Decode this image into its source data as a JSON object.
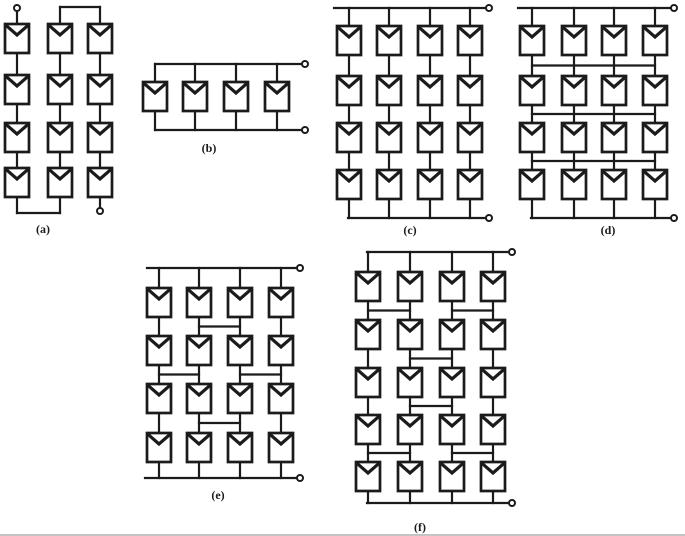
{
  "figure": {
    "canvas": {
      "width": 685,
      "height": 536
    },
    "background": "#ffffff",
    "line_color": "#1b1b1b",
    "edge_line_color": "#c4c4c4",
    "wire_width": 2.2,
    "terminal_radius": 3,
    "label_font_size": 12,
    "module": {
      "width": 24,
      "height": 29,
      "notch": 11,
      "stroke": 2.7,
      "notch_stroke": 3.2
    },
    "diagrams": [
      {
        "id": "a",
        "label": "(a)",
        "config": "series-serpentine-string",
        "kind": "serpentine",
        "col_x": [
          17,
          60,
          100
        ],
        "row_y": [
          24,
          75,
          123,
          168
        ],
        "top_bridge_y": 7,
        "bottom_bridge_y": 213,
        "top_terminal": {
          "x": 17,
          "y": 8
        },
        "bottom_terminal": {
          "x": 100,
          "y": 211
        },
        "label_pos": [
          43,
          229
        ]
      },
      {
        "id": "b",
        "label": "(b)",
        "config": "parallel",
        "kind": "parallel",
        "module_x": [
          155,
          195,
          236,
          277
        ],
        "row_y": 82,
        "top_bus_y": 64,
        "bottom_bus_y": 130,
        "right_x": 305,
        "label_pos": [
          209,
          148
        ]
      },
      {
        "id": "c",
        "label": "(c)",
        "config": "series-parallel",
        "kind": "ladder",
        "col_x": [
          349,
          389,
          430,
          470
        ],
        "row_y": [
          26,
          76,
          123,
          170
        ],
        "top_bus_y": 8,
        "bottom_bus_y": 218,
        "right_x": 489,
        "bus_left_top": 334,
        "bus_left_bottom": 348,
        "ties": [],
        "label_pos": [
          410,
          230
        ]
      },
      {
        "id": "d",
        "label": "(d)",
        "config": "total-cross-tied",
        "kind": "ladder",
        "col_x": [
          532,
          574,
          614,
          655
        ],
        "row_y": [
          26,
          76,
          123,
          170
        ],
        "top_bus_y": 8,
        "bottom_bus_y": 218,
        "right_x": 674,
        "bus_left_top": 518,
        "bus_left_bottom": 531,
        "ties": [
          {
            "gap": 0,
            "spans": [
              [
                0,
                3
              ]
            ]
          },
          {
            "gap": 1,
            "spans": [
              [
                0,
                3
              ]
            ]
          },
          {
            "gap": 2,
            "spans": [
              [
                0,
                3
              ]
            ]
          }
        ],
        "label_pos": [
          608,
          230
        ]
      },
      {
        "id": "e",
        "label": "(e)",
        "config": "bridge-linked",
        "kind": "ladder",
        "col_x": [
          159,
          199,
          240,
          281
        ],
        "row_y": [
          288,
          336,
          384,
          433
        ],
        "top_bus_y": 268,
        "bottom_bus_y": 478,
        "right_x": 300,
        "bus_left_top": 147,
        "bus_left_bottom": 145,
        "ties": [
          {
            "gap": 0,
            "spans": [
              [
                1,
                2
              ]
            ]
          },
          {
            "gap": 1,
            "spans": [
              [
                0,
                1
              ],
              [
                2,
                3
              ]
            ]
          },
          {
            "gap": 2,
            "spans": [
              [
                1,
                2
              ]
            ]
          }
        ],
        "label_pos": [
          218,
          495
        ]
      },
      {
        "id": "f",
        "label": "(f)",
        "config": "honeycomb",
        "kind": "ladder",
        "col_x": [
          368,
          410,
          452,
          493
        ],
        "row_y": [
          272,
          320,
          368,
          415,
          462
        ],
        "top_bus_y": 252,
        "bottom_bus_y": 503,
        "right_x": 512,
        "bus_left_top": 367,
        "bus_left_bottom": 367,
        "ties": [
          {
            "gap": 0,
            "spans": [
              [
                0,
                1
              ],
              [
                2,
                3
              ]
            ]
          },
          {
            "gap": 1,
            "spans": [
              [
                1,
                2
              ]
            ]
          },
          {
            "gap": 2,
            "spans": [
              [
                1,
                2
              ]
            ]
          },
          {
            "gap": 3,
            "spans": [
              [
                0,
                1
              ],
              [
                2,
                3
              ]
            ]
          }
        ],
        "label_pos": [
          420,
          527
        ]
      }
    ]
  }
}
